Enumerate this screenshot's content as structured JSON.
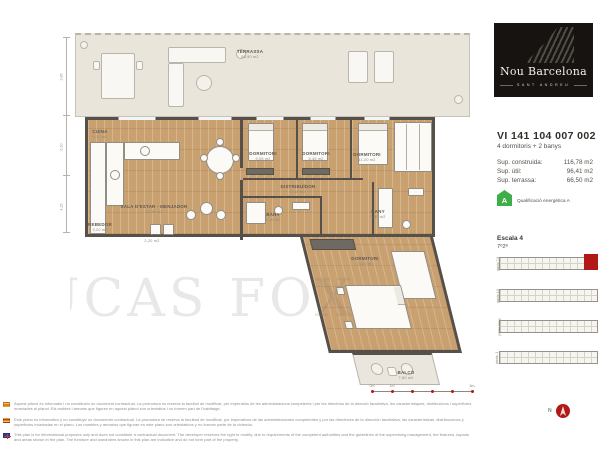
{
  "brand": {
    "name": "Nou Barcelona",
    "subtitle": "SANT ANDREU"
  },
  "unit": {
    "code": "VI 141 104 007 002",
    "summary": "4 dormitoris + 2 banys",
    "areas": [
      {
        "label": "Sup. construida:",
        "value": "116,78 m2"
      },
      {
        "label": "Sup. útil:",
        "value": "96,41 m2"
      },
      {
        "label": "Sup. terrassa:",
        "value": "66,50 m2"
      }
    ],
    "energy": {
      "letter": "A",
      "label": "Qualificació energètica A"
    }
  },
  "location": {
    "escala": "Escala 4",
    "pis": "7º2ª",
    "strips": [
      {
        "label": "planta 7-8"
      },
      {
        "label": "planta 1-6"
      },
      {
        "label": "planta baixa"
      },
      {
        "label": "planta -1"
      }
    ],
    "north_label": "N"
  },
  "plan": {
    "watermark": "LUCAS FOX",
    "rooms": [
      {
        "name": "TERRASSA",
        "area": "58,90 m2"
      },
      {
        "name": "CUINA",
        "area": "9,10 m2"
      },
      {
        "name": "SALA D'ESTAR - MENJADOR",
        "area": "28,35 m2"
      },
      {
        "name": "REBEDOR",
        "area": "3,20 m2"
      },
      {
        "name": "SAFAREIG",
        "area": "2,20 m2"
      },
      {
        "name": "DORMITORI",
        "area": "9,05 m2"
      },
      {
        "name": "DORMITORI",
        "area": "8,45 m2"
      },
      {
        "name": "DISTRIBUÏDOR",
        "area": "5,10 m2"
      },
      {
        "name": "BANY",
        "area": "4,10 m2"
      },
      {
        "name": "DORMITORI",
        "area": "11,20 m2"
      },
      {
        "name": "BANY",
        "area": "3,50 m2"
      },
      {
        "name": "DORMITORI",
        "area": "13,60 m2"
      },
      {
        "name": "BALCÓ",
        "area": "7,60 m2"
      }
    ],
    "dimensions": [
      "3,85",
      "6,10",
      "4,25"
    ],
    "scalebar_labels": [
      "0m",
      "1m",
      "5m"
    ]
  },
  "disclaimers": [
    {
      "lang": "ca",
      "text": "Aquest plànol és informatiu i no constitueix un document contractual. La promotora es reserva la facultat de modificar, per imperatius de les administracions competents i per les directrius de la direcció facultativa, les característiques, distribucions i superfícies mostrades al plànol. Els mobles i armaris que figuren en aquest plànol són orientatius i no formen part de l'habitatge."
    },
    {
      "lang": "es",
      "text": "Este plano es informativo y no constituye un documento contractual. La promotora se reserva la facultad de modificar, por imperativos de las administraciones competentes y por las directrices de la dirección facultativa, las características, distribuciones y superficies mostradas en el plano. Los muebles y armarios que figuran en este plano son orientativos y no forman parte de la vivienda."
    },
    {
      "lang": "en",
      "text": "This plan is for informational purposes only and does not constitute a contractual document. The developer reserves the right to modify, due to requirements of the competent authorities and the guidelines of the supervising management, the features, layouts and areas shown in the plan. The furniture and wardrobes shown in this plan are indicative and do not form part of the property."
    }
  ]
}
